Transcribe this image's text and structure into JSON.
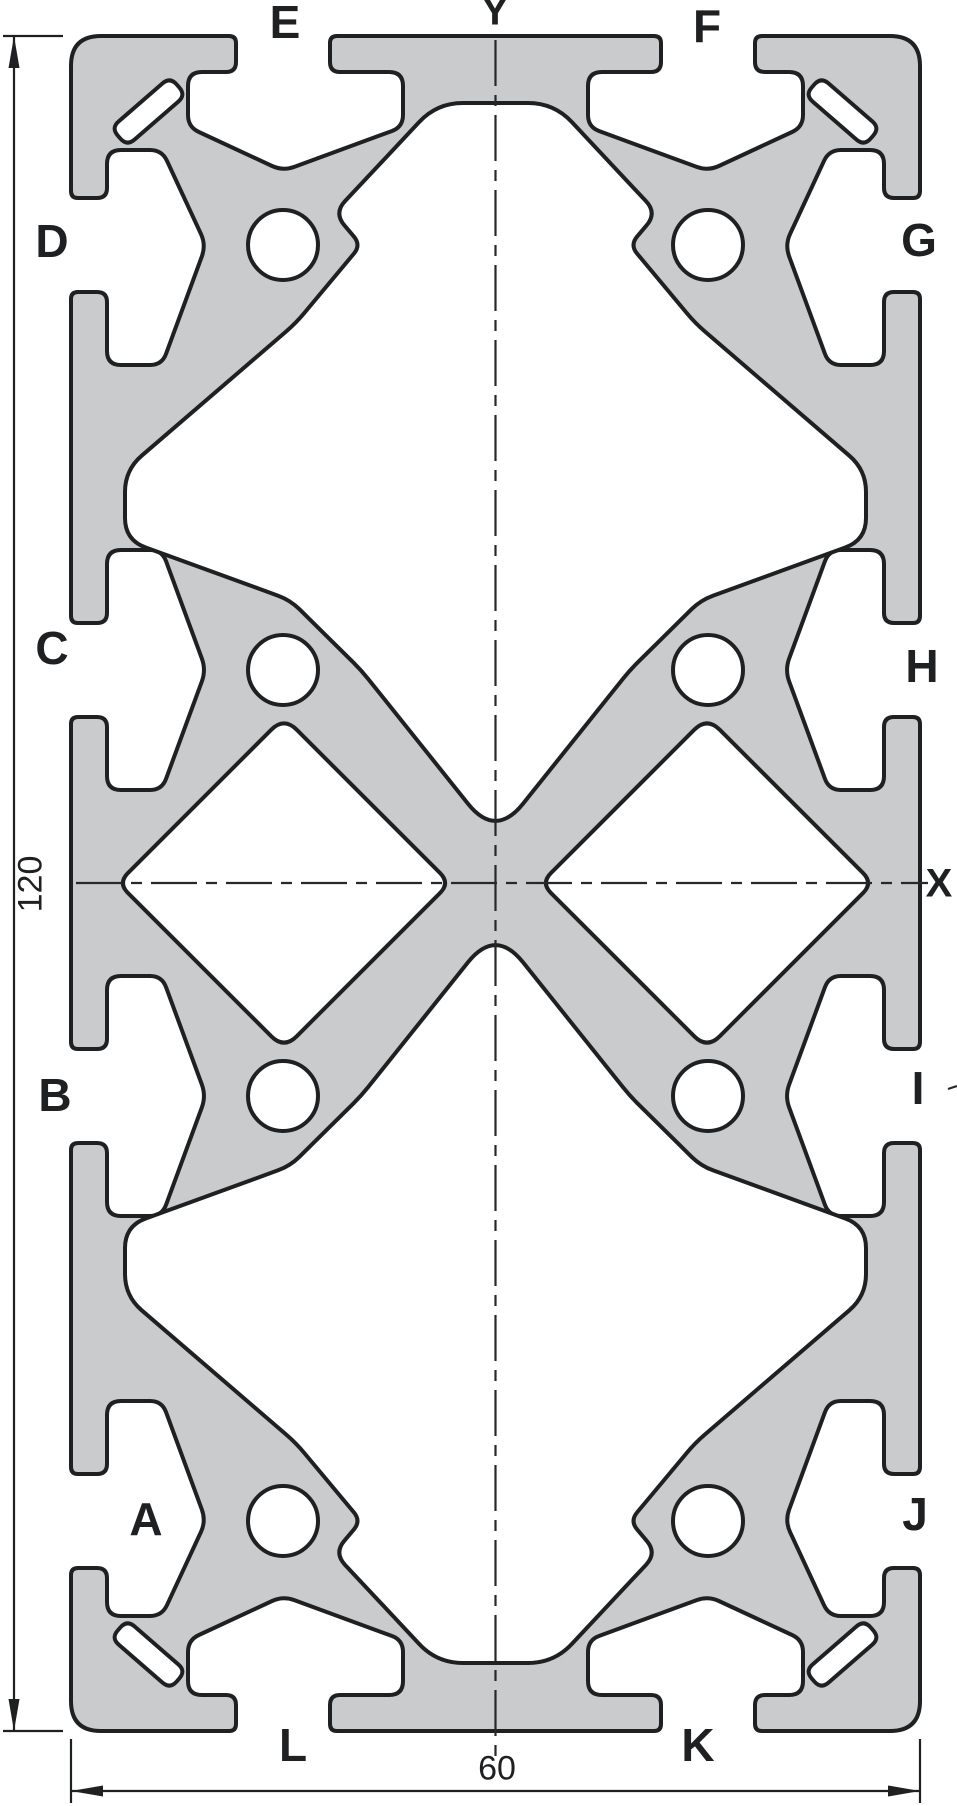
{
  "drawing": {
    "kind": "extrusion-profile-cross-section",
    "colors": {
      "background": "#ffffff",
      "profile_fill": "#cacbcc",
      "outline": "#1e2022",
      "centerline": "#26282a",
      "dimension": "#1e2022"
    }
  },
  "slot_labels": [
    {
      "text": "A",
      "x": 146,
      "y": 1519
    },
    {
      "text": "B",
      "x": 55,
      "y": 1095
    },
    {
      "text": "C",
      "x": 52,
      "y": 648
    },
    {
      "text": "D",
      "x": 52,
      "y": 241
    },
    {
      "text": "E",
      "x": 285,
      "y": 22
    },
    {
      "text": "F",
      "x": 707,
      "y": 26
    },
    {
      "text": "G",
      "x": 919,
      "y": 240
    },
    {
      "text": "H",
      "x": 922,
      "y": 666
    },
    {
      "text": "I",
      "x": 918,
      "y": 1088
    },
    {
      "text": "J",
      "x": 915,
      "y": 1514
    },
    {
      "text": "K",
      "x": 698,
      "y": 1745
    },
    {
      "text": "L",
      "x": 293,
      "y": 1745
    }
  ],
  "axis_labels": [
    {
      "text": "X",
      "x": 939,
      "y": 884
    },
    {
      "text": "Y",
      "x": 495,
      "y": 12
    }
  ],
  "dimensions": {
    "height": {
      "text": "120",
      "x": 31,
      "y": 884
    },
    "width": {
      "text": "60",
      "x": 497,
      "y": 1769
    }
  }
}
